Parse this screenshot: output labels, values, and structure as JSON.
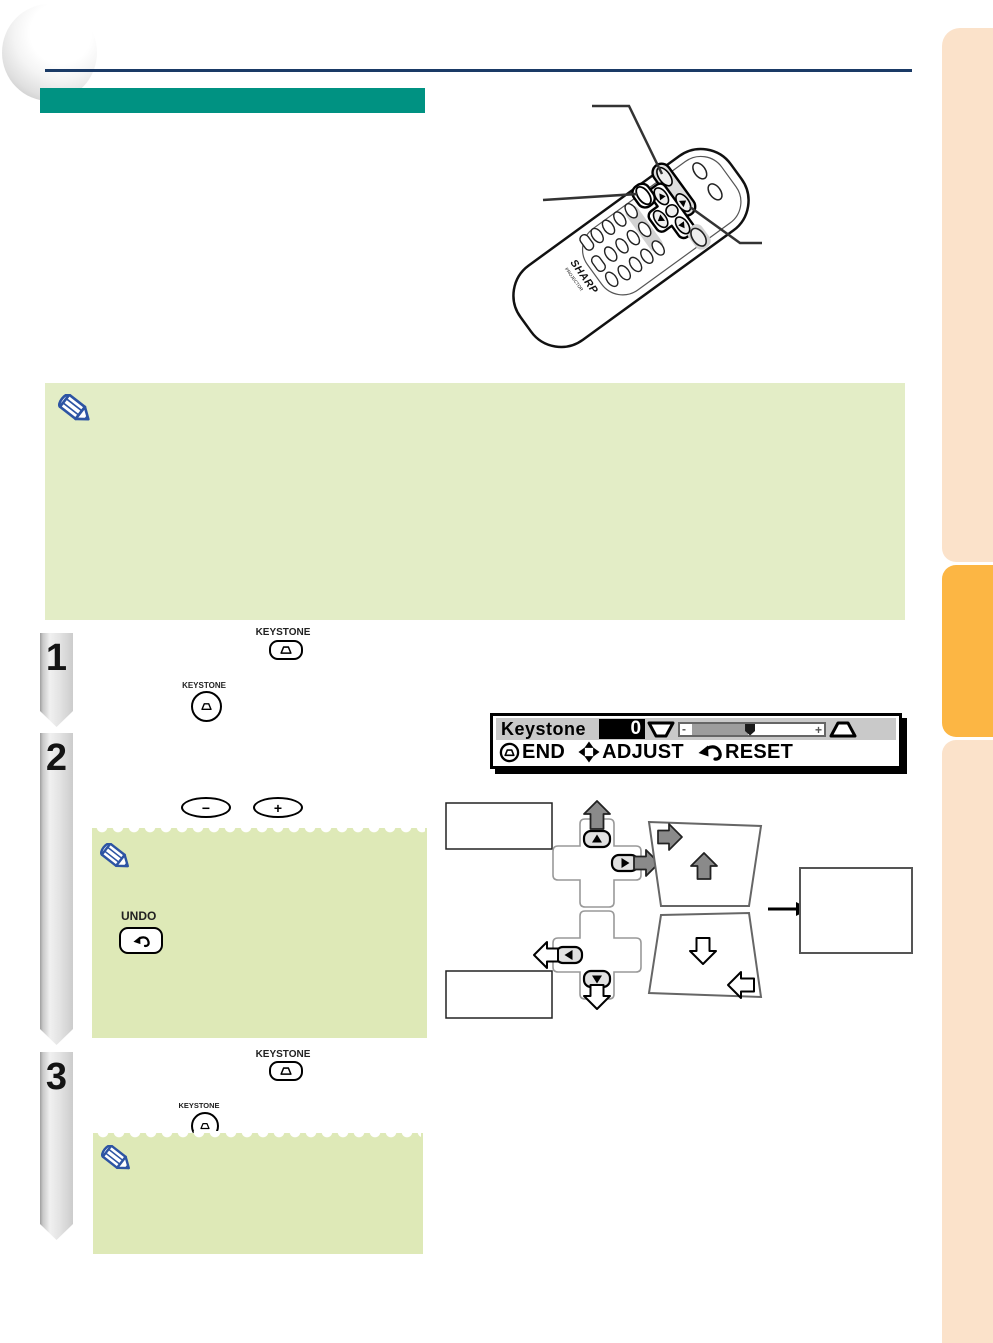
{
  "page": {
    "kind": "projector manual page (scanned); body text not legible in scan"
  },
  "palette": {
    "title_bar_teal": "#009282",
    "header_rule_navy": "#1a3a66",
    "note_green_large": "#e3edc6",
    "note_green_small": "#dee9b7",
    "sidebar_peach": "#fbe2ca",
    "sidebar_tab_orange": "#fcb644",
    "step_banner_gray": "#e3e3e3"
  },
  "steps": [
    {
      "number": "1"
    },
    {
      "number": "2"
    },
    {
      "number": "3"
    }
  ],
  "controls": {
    "keystone": "KEYSTONE",
    "undo": "UNDO",
    "minus": "−",
    "plus": "+"
  },
  "osd": {
    "title": "Keystone",
    "value": "0",
    "slider_minus": "-",
    "slider_plus": "+",
    "end": "END",
    "adjust": "ADJUST",
    "reset": "RESET"
  },
  "remote": {
    "brand": "SHARP",
    "brand_sub": "PROJECTOR"
  }
}
